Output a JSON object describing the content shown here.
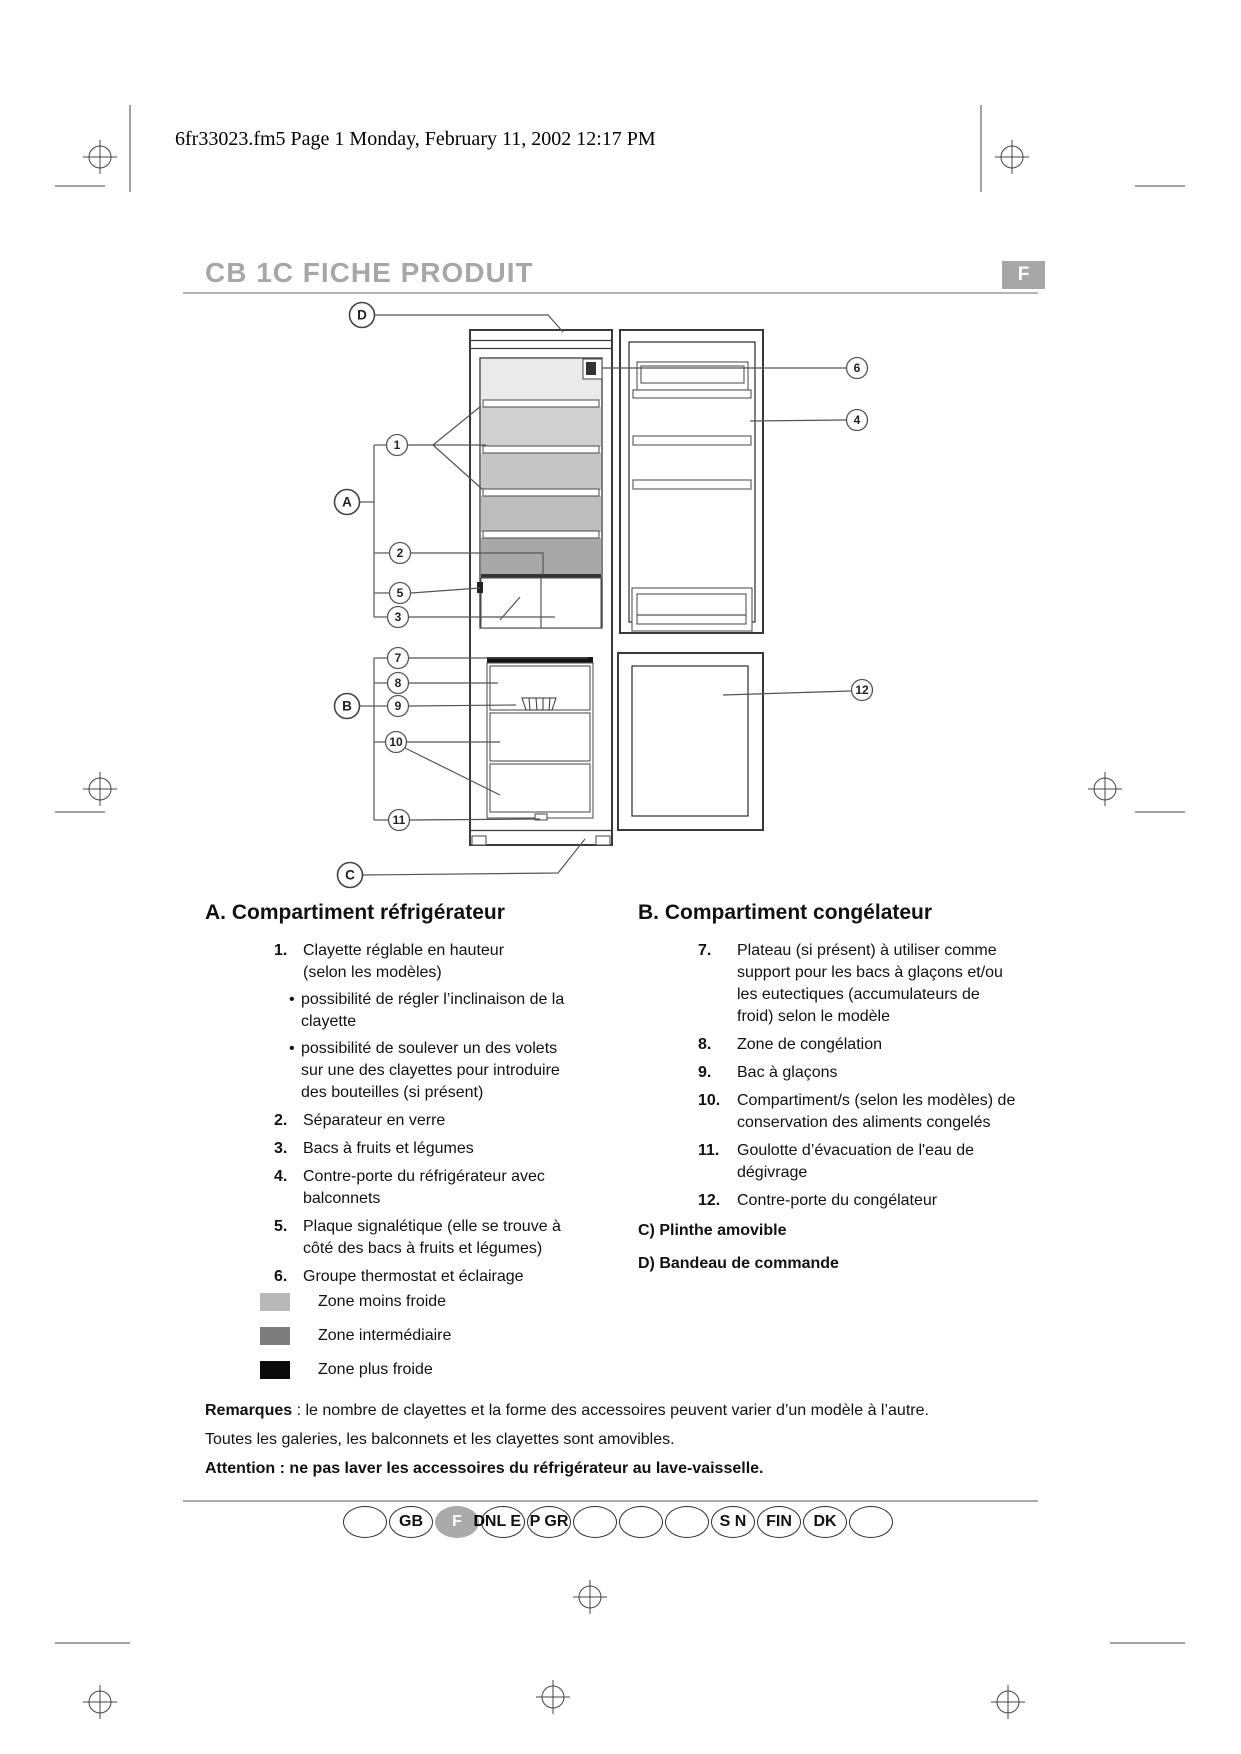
{
  "page": {
    "header": "6fr33023.fm5  Page 1  Monday, February 11, 2002  12:17 PM",
    "title": "CB 1C FICHE PRODUIT",
    "title_color": "#a7a7a7",
    "language_badge": "F",
    "badge_color": "#a7a7a7"
  },
  "diagram": {
    "callouts": {
      "d": "D",
      "a": "A",
      "b": "B",
      "c": "C",
      "n1": "1",
      "n2": "2",
      "n3": "3",
      "n4": "4",
      "n5": "5",
      "n6": "6",
      "n7": "7",
      "n8": "8",
      "n9": "9",
      "n10": "10",
      "n11": "11",
      "n12": "12"
    },
    "zone_fills": [
      "#eaeaea",
      "#d0d0d0",
      "#c6c6c6",
      "#bdbdbd",
      "#a8a8a8"
    ]
  },
  "sections": {
    "bullet_char": "•",
    "a": {
      "heading": "A. Compartiment réfrigérateur",
      "items": [
        {
          "num": "1.",
          "lines": [
            "Clayette réglable en hauteur",
            "(selon les modèles)"
          ],
          "bullets": [
            [
              "possibilité de régler l’inclinaison de la",
              "clayette"
            ],
            [
              "possibilité de soulever un des volets",
              "sur une des clayettes pour introduire",
              "des bouteilles (si présent)"
            ]
          ]
        },
        {
          "num": "2.",
          "lines": [
            "Séparateur en verre"
          ]
        },
        {
          "num": "3.",
          "lines": [
            "Bacs à fruits et légumes"
          ]
        },
        {
          "num": "4.",
          "lines": [
            "Contre-porte du réfrigérateur avec",
            "balconnets"
          ]
        },
        {
          "num": "5.",
          "lines": [
            "Plaque signalétique (elle se trouve à",
            "côté des bacs à fruits et légumes)"
          ]
        },
        {
          "num": "6.",
          "lines": [
            "Groupe thermostat et éclairage"
          ]
        }
      ]
    },
    "b": {
      "heading": "B. Compartiment congélateur",
      "items": [
        {
          "num": "7.",
          "lines": [
            "Plateau (si présent) à utiliser comme",
            "support pour les bacs à glaçons et/ou",
            "les eutectiques (accumulateurs de",
            "froid) selon le modèle"
          ]
        },
        {
          "num": "8.",
          "lines": [
            "Zone de congélation"
          ]
        },
        {
          "num": "9.",
          "lines": [
            "Bac à glaçons"
          ]
        },
        {
          "num": "10.",
          "lines": [
            "Compartiment/s (selon les modèles) de",
            "conservation des aliments congelés"
          ]
        },
        {
          "num": "11.",
          "lines": [
            "Goulotte d’évacuation de l'eau de",
            "dégivrage"
          ]
        },
        {
          "num": "12.",
          "lines": [
            "Contre-porte du congélateur"
          ]
        }
      ],
      "extra": [
        "C) Plinthe amovible",
        "D) Bandeau de commande"
      ]
    }
  },
  "legend": {
    "items": [
      {
        "color": "#b8b8b8",
        "label": "Zone moins froide"
      },
      {
        "color": "#7d7d7d",
        "label": "Zone intermédiaire"
      },
      {
        "color": "#0a0a0a",
        "label": "Zone plus froide"
      }
    ]
  },
  "notes": {
    "remarks_label": "Remarques",
    "remarks_text": " : le nombre de clayettes et la forme des accessoires peuvent varier d’un modèle à l’autre.",
    "remarks_line2": "Toutes les galeries, les balconnets et les clayettes sont amovibles.",
    "attention": "Attention : ne pas laver les accessoires du réfrigérateur au lave-vaisselle."
  },
  "footer": {
    "selected_fill": "#aaaaaa",
    "languages": [
      {
        "label": ""
      },
      {
        "label": "GB"
      },
      {
        "label": "F",
        "selected": true,
        "suffix": "D"
      },
      {
        "label": "NL E"
      },
      {
        "label": "P GR"
      },
      {
        "label": ""
      },
      {
        "label": ""
      },
      {
        "label": ""
      },
      {
        "label": "S N"
      },
      {
        "label": "FIN"
      },
      {
        "label": "DK"
      },
      {
        "label": ""
      }
    ]
  }
}
